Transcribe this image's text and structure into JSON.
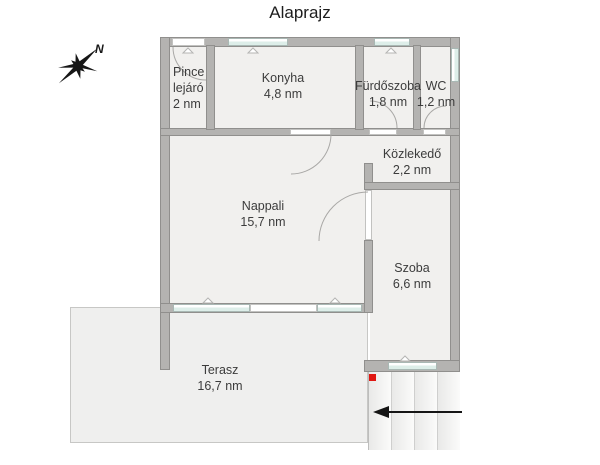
{
  "title": "Alaprajz",
  "compass": {
    "north_label": "N"
  },
  "rooms": [
    {
      "name": "Pince lejáró",
      "area": "2 nm"
    },
    {
      "name": "Konyha",
      "area": "4,8 nm"
    },
    {
      "name": "Fürdőszoba",
      "area": "1,8 nm"
    },
    {
      "name": "WC",
      "area": "1,2 nm"
    },
    {
      "name": "Közlekedő",
      "area": "2,2 nm"
    },
    {
      "name": "Nappali",
      "area": "15,7 nm"
    },
    {
      "name": "Szoba",
      "area": "6,6 nm"
    },
    {
      "name": "Terasz",
      "area": "16,7 nm"
    }
  ],
  "stairs": {
    "steps": 4,
    "direction": "left"
  },
  "colors": {
    "wall": "#b4b3b1",
    "wall_edge": "#908f8d",
    "room_fill": "#f1f0ee",
    "terrace_fill": "#efefee",
    "window_glass": "#ddeee9",
    "marker_red": "#e01712",
    "text": "#3c3c3c"
  }
}
